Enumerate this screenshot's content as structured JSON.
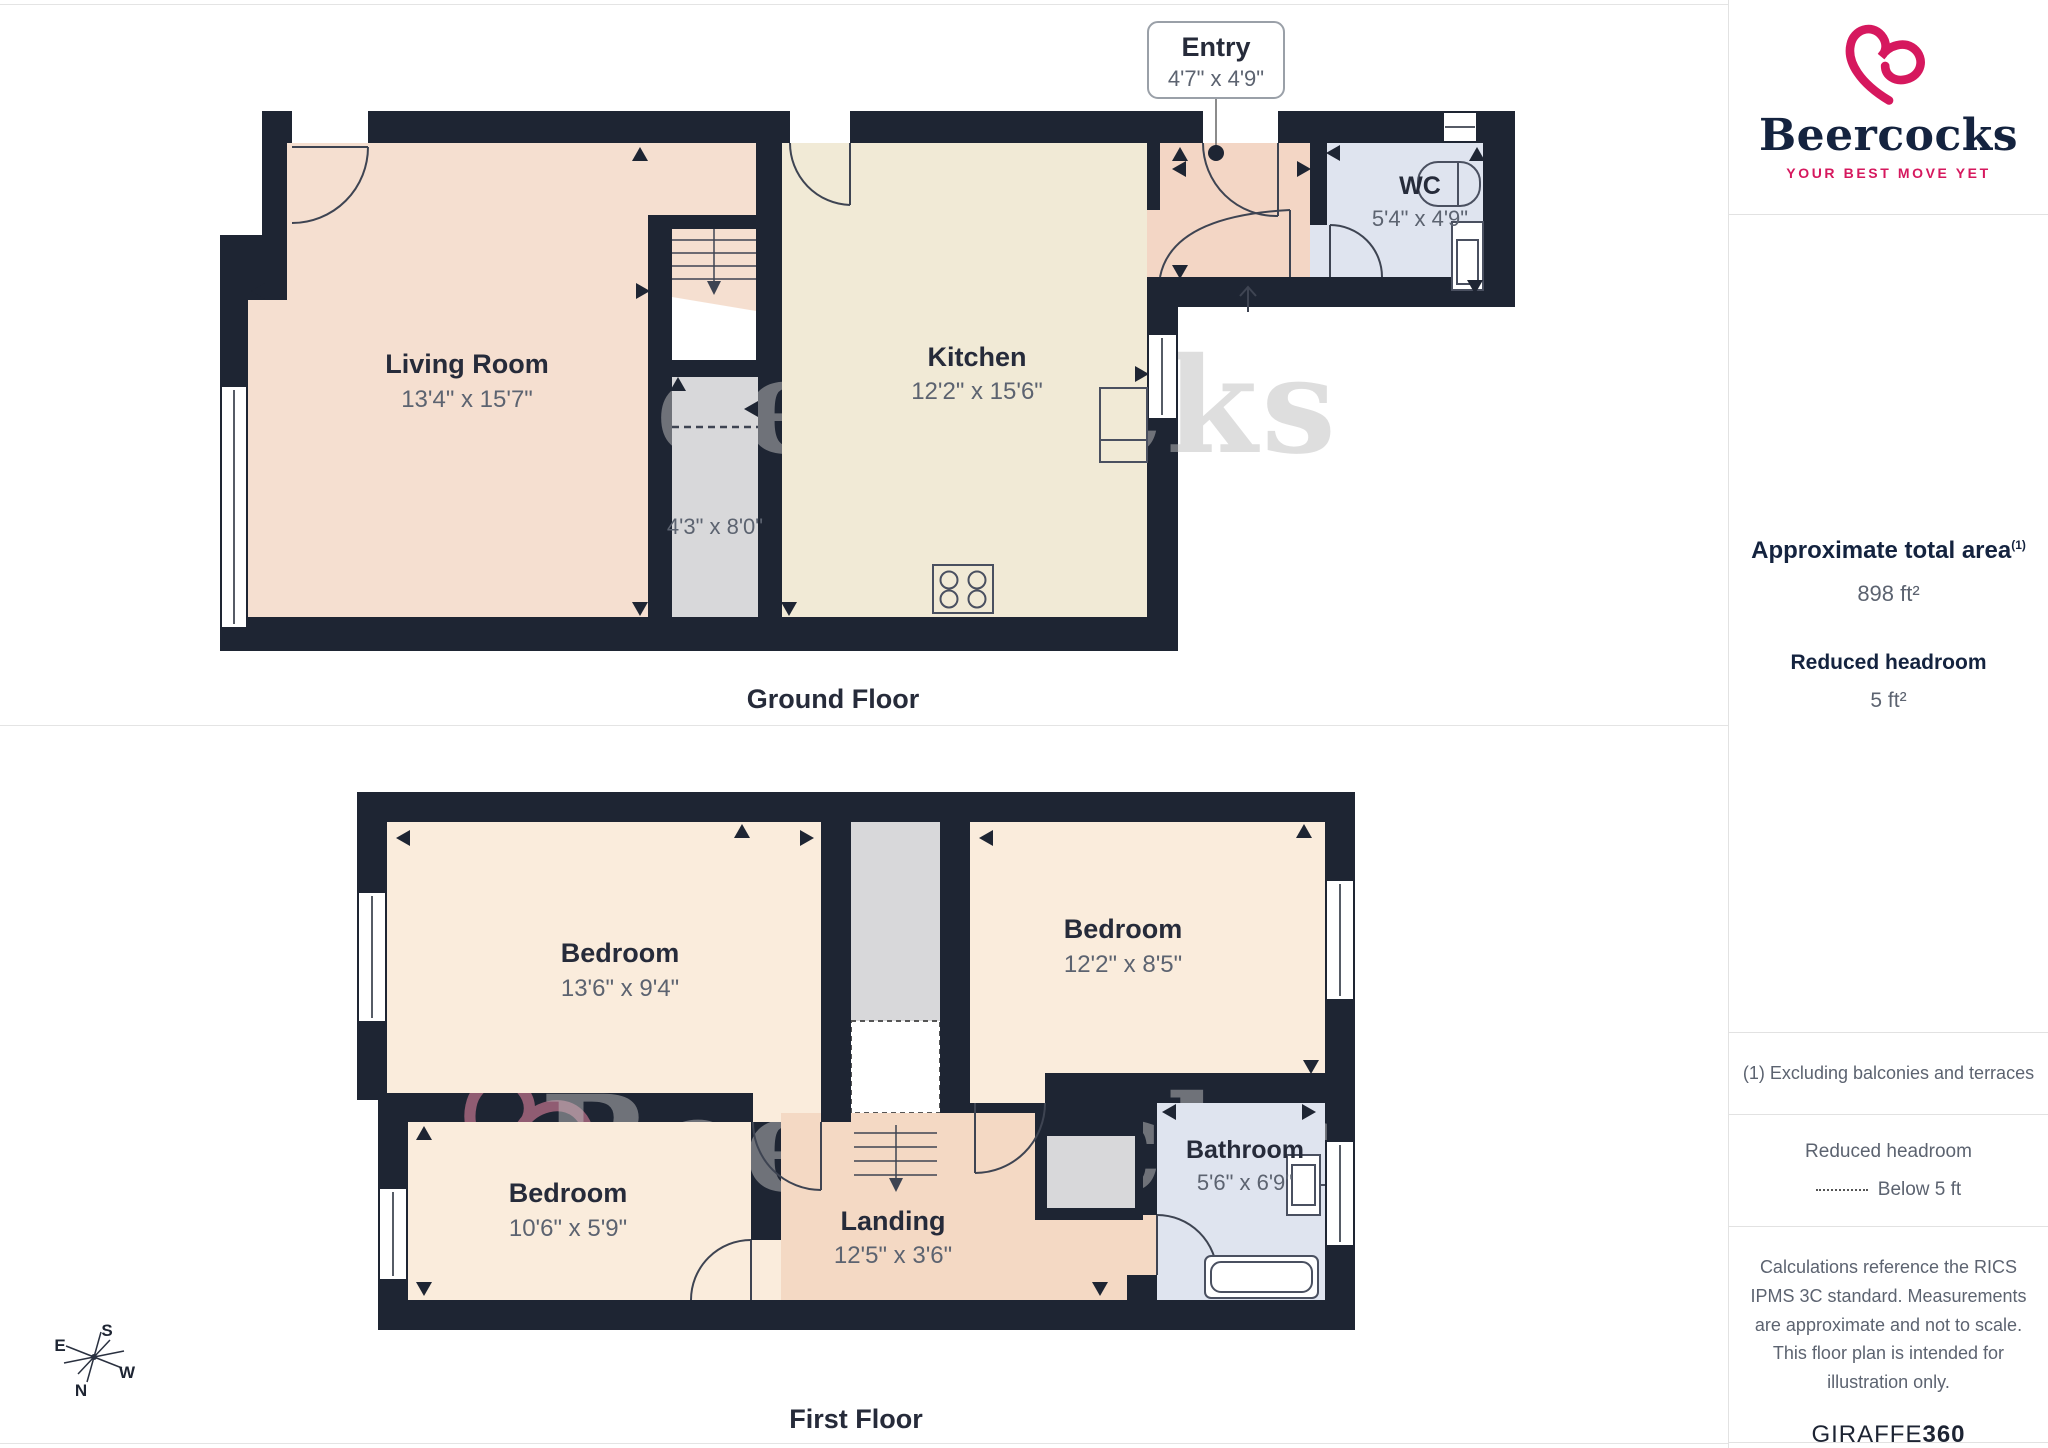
{
  "branding": {
    "name": "Beercocks",
    "tagline": "YOUR BEST MOVE YET",
    "provider": "GIRAFFE",
    "provider_suffix": "360"
  },
  "sidebar": {
    "area_title": "Approximate total area",
    "area_sup": "(1)",
    "area_value": "898 ft²",
    "headroom_title": "Reduced headroom",
    "headroom_value": "5 ft²",
    "note1": "(1) Excluding balconies and terraces",
    "legend_title": "Reduced headroom",
    "legend_value": "Below 5 ft",
    "disclaimer": "Calculations reference the RICS IPMS 3C standard. Measurements are approximate and not to scale. This floor plan is intended for illustration only."
  },
  "ground_floor": {
    "title": "Ground Floor",
    "entry": {
      "name": "Entry",
      "dims": "4'7\" x 4'9\""
    },
    "living": {
      "name": "Living Room",
      "dims": "13'4\" x 15'7\""
    },
    "kitchen": {
      "name": "Kitchen",
      "dims": "12'2\" x 15'6\""
    },
    "storage": {
      "dims": "4'3\" x 8'0\""
    },
    "wc": {
      "name": "WC",
      "dims": "5'4\" x 4'9\""
    }
  },
  "first_floor": {
    "title": "First Floor",
    "bedroom1": {
      "name": "Bedroom",
      "dims": "13'6\" x 9'4\""
    },
    "bedroom2": {
      "name": "Bedroom",
      "dims": "12'2\" x 8'5\""
    },
    "bedroom3": {
      "name": "Bedroom",
      "dims": "10'6\" x 5'9\""
    },
    "landing": {
      "name": "Landing",
      "dims": "12'5\" x 3'6\""
    },
    "bathroom": {
      "name": "Bathroom",
      "dims": "5'6\" x 6'9\""
    }
  },
  "compass": {
    "n": "N",
    "s": "S",
    "e": "E",
    "w": "W"
  },
  "watermark": {
    "text": "Beercocks"
  },
  "colors": {
    "wall": "#1e2533",
    "living": "#f5dfd0",
    "kitchen": "#f1ead6",
    "entry": "#f3d6c5",
    "wcfill": "#dfe4ef",
    "grayfill": "#d8d8da",
    "peach": "#faecdc",
    "landing": "#f4d9c4",
    "navy": "#262b3a",
    "dim": "#5c6370",
    "accent": "#d6185e",
    "logonavy": "#14233f",
    "wmpink": "#ef8aa5",
    "wmgray": "#bfbfbf"
  }
}
